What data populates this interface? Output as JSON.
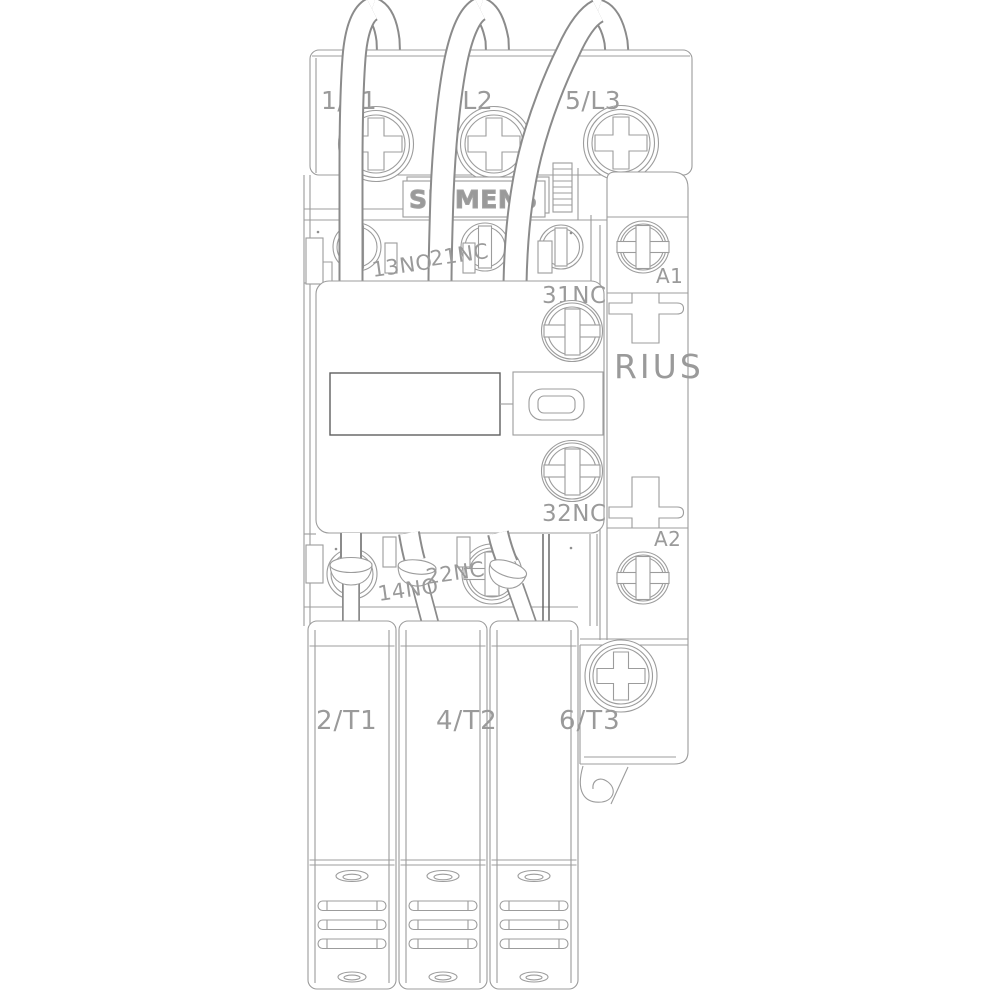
{
  "product_drawing": {
    "brand": "SIEMENS",
    "series_text_visible": "RIUS",
    "line_side_terminals": [
      "1/L1",
      "3/L2",
      "5/L3"
    ],
    "load_side_terminals": [
      "2/T1",
      "4/T2",
      "6/T3"
    ],
    "auxiliary_contacts_upper": [
      "13NO",
      "21NC"
    ],
    "auxiliary_contacts_lower": [
      "14NO",
      "22NC"
    ],
    "aux_switch_block_terminals": [
      "31NC",
      "32NC"
    ],
    "coil_terminals": [
      "A1",
      "A2"
    ],
    "colors": {
      "background": "#ffffff",
      "line": "#9c9c9c",
      "dark_line": "#5f5f5f",
      "label": "#9a9a9a",
      "wire_outline": "#8b8b8b"
    }
  }
}
